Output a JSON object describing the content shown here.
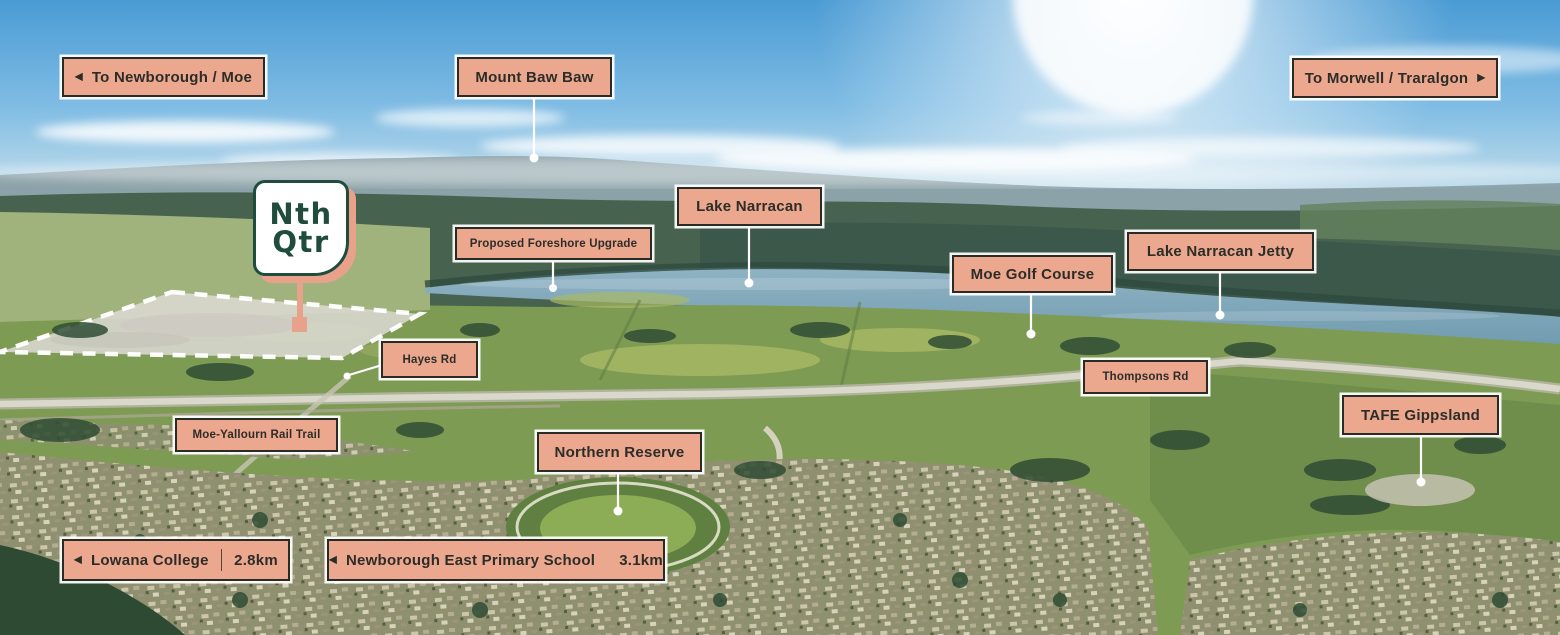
{
  "logo": {
    "line1": "Nth",
    "line2": "Qtr"
  },
  "icons": {
    "arrow_left": "◀",
    "arrow_right": "▶"
  },
  "colors": {
    "sign_bg": "#ECA78F",
    "sign_border": "#2B2B26",
    "sign_text": "#2D2D28",
    "logo_green": "#1F4C3D",
    "logo_shadow": "#E8A28C",
    "leader": "#FFFFFF"
  },
  "signs": {
    "to_newborough": {
      "label": "To Newborough / Moe"
    },
    "mount_baw_baw": {
      "label": "Mount Baw Baw"
    },
    "to_morwell": {
      "label": "To Morwell / Traralgon"
    },
    "proposed_foreshore_upgrade": {
      "label": "Proposed Foreshore Upgrade"
    },
    "lake_narracan": {
      "label": "Lake Narracan"
    },
    "moe_golf_course": {
      "label": "Moe Golf Course"
    },
    "lake_narracan_jetty": {
      "label": "Lake Narracan Jetty"
    },
    "hayes_rd": {
      "label": "Hayes Rd"
    },
    "thompsons_rd": {
      "label": "Thompsons Rd"
    },
    "tafe_gippsland": {
      "label": "TAFE Gippsland"
    },
    "moe_yallourn_rail_trail": {
      "label": "Moe-Yallourn Rail Trail"
    },
    "northern_reserve": {
      "label": "Northern Reserve"
    },
    "lowana_college": {
      "label": "Lowana College",
      "distance": "2.8km"
    },
    "newborough_east_primary": {
      "label": "Newborough East Primary School",
      "distance": "3.1km"
    }
  }
}
